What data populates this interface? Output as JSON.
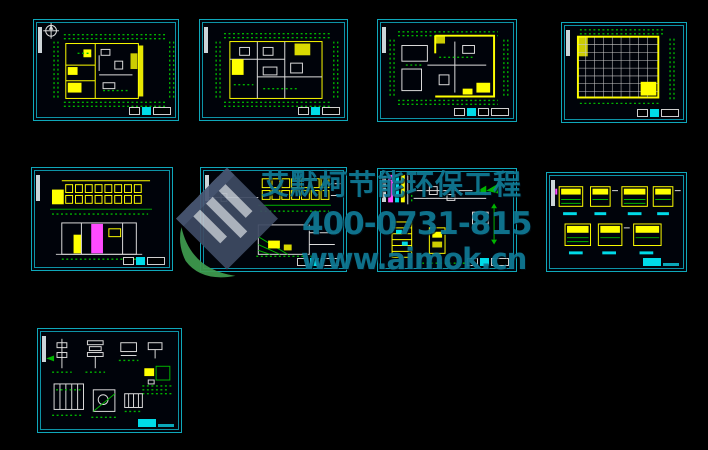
{
  "page": {
    "background_color": "#000000",
    "description": "Black CAD viewer collage of nine architectural drawing sheets"
  },
  "watermark": {
    "company_line": "艾默柯节能环保工程",
    "phone_line": "400-0731-815",
    "website_line": "www.aimok.cn",
    "text_color": "#10809c",
    "logo": {
      "name": "aimok-logo",
      "body_color": "#3e4a63",
      "stripe_color": "#b9c0ca",
      "swoosh_color": "#3f9b4f"
    }
  },
  "colors": {
    "sheet_border_cyan": "#0fa8ba",
    "dimension_green": "#00b400",
    "wall_yellow": "#ffff00",
    "line_white": "#dcdcdc",
    "accent_magenta": "#ff4bff",
    "accent_cyan": "#00dbe8"
  },
  "sheets": [
    {
      "id": "floor-plan-1",
      "row": 1,
      "col": 1,
      "kind": "floor plan with north compass"
    },
    {
      "id": "floor-plan-2",
      "row": 1,
      "col": 2,
      "kind": "floor plan"
    },
    {
      "id": "floor-plan-3",
      "row": 1,
      "col": 3,
      "kind": "floor plan with heavy yellow outline"
    },
    {
      "id": "ceiling-grid-plan",
      "row": 1,
      "col": 4,
      "kind": "reflected ceiling grid plan"
    },
    {
      "id": "elevation-section-1",
      "row": 2,
      "col": 1,
      "kind": "building elevation over section"
    },
    {
      "id": "elevation-section-2",
      "row": 2,
      "col": 2,
      "kind": "building elevation over section"
    },
    {
      "id": "stair-detail-sheet",
      "row": 2,
      "col": 3,
      "kind": "stair and shaft details"
    },
    {
      "id": "node-details-sheet",
      "row": 2,
      "col": 4,
      "kind": "seven small node details"
    },
    {
      "id": "misc-details-sheet",
      "row": 3,
      "col": 1,
      "kind": "miscellaneous construction details"
    }
  ],
  "sheet_count": 9
}
